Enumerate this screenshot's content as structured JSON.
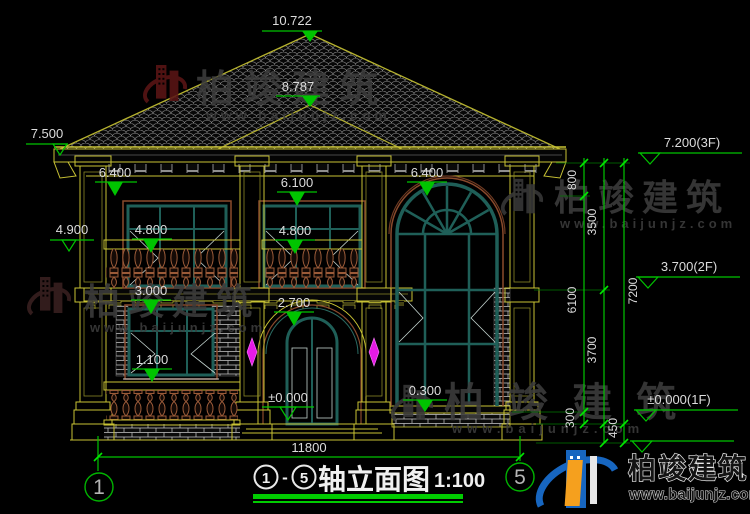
{
  "labels": {
    "peak": "10.722",
    "porch_peak": "8.787",
    "left_eave": "7.500",
    "left_mid": "4.900",
    "soffit_left": "6.400",
    "win2f_top": "6.100",
    "rail2f_left": "4.800",
    "rail2f_center": "4.800",
    "arch_top": "6.400",
    "balcony": "3.000",
    "entry_arch": "2.700",
    "rail1f": "1.100",
    "floor": "±0.000",
    "arch_sill": "0.300"
  },
  "right_levels": {
    "f3": "7.200(3F)",
    "f2": "3.700(2F)",
    "f1": "±0.000(1F)"
  },
  "vdims": {
    "d800": "800",
    "d3500": "3500",
    "d6100": "6100",
    "d7200": "7200",
    "d3700": "3700",
    "d300": "300",
    "d450": "450"
  },
  "hdims": {
    "total_width": "11800"
  },
  "axes": {
    "left": "1",
    "right": "5"
  },
  "title_block": {
    "axis_from": "1",
    "separator": "-",
    "axis_to": "5",
    "name": "轴立面图",
    "scale": "1:100"
  },
  "brand": {
    "name": "柏竣建筑",
    "url": "www.baijunjz.com"
  },
  "colors": {
    "dim_green": "#00c400",
    "cad_yellow": "#c8c234",
    "window_teal": "#1f5f58",
    "trim_brown": "#8a4a2c",
    "ornament_magenta": "#e61ae6",
    "watermark_gray": "#3d3d3d",
    "watermark_red": "#5a1515",
    "logo_blue": "#1766c0",
    "logo_orange": "#f5a01e"
  }
}
